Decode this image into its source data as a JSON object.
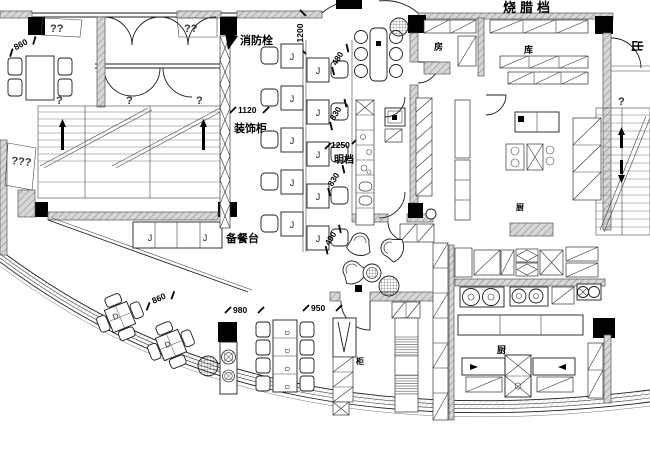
{
  "colors": {
    "background": "#ffffff",
    "line": "#1c1c1c",
    "wall_fill": "#d7d7d7",
    "wall_hatch": "#8f8f8f",
    "column": "#000000"
  },
  "title": {
    "station": "烧腊档"
  },
  "labels": {
    "fire_hydrant": "消防栓",
    "decor_cabinet": "装饰柜",
    "prep_counter": "备餐台",
    "open_counter": "明档",
    "room_left": "房",
    "room_mid": "库",
    "exit": "出",
    "kitchen_mid": "厨",
    "kitchen_bottom": "厨",
    "cabinet": "柜"
  },
  "dimensions": {
    "d1200": "1200",
    "d1120": "1120",
    "d1250": "1250",
    "d480": "480",
    "d830a": "830",
    "d830b": "830",
    "d490": "490",
    "d980": "980",
    "d950": "950",
    "d860a": "860",
    "d860b": "860"
  },
  "placeholders": {
    "q1": "?",
    "q2": "??",
    "q3": "???"
  },
  "letters": {
    "j": "J",
    "d": "D"
  }
}
